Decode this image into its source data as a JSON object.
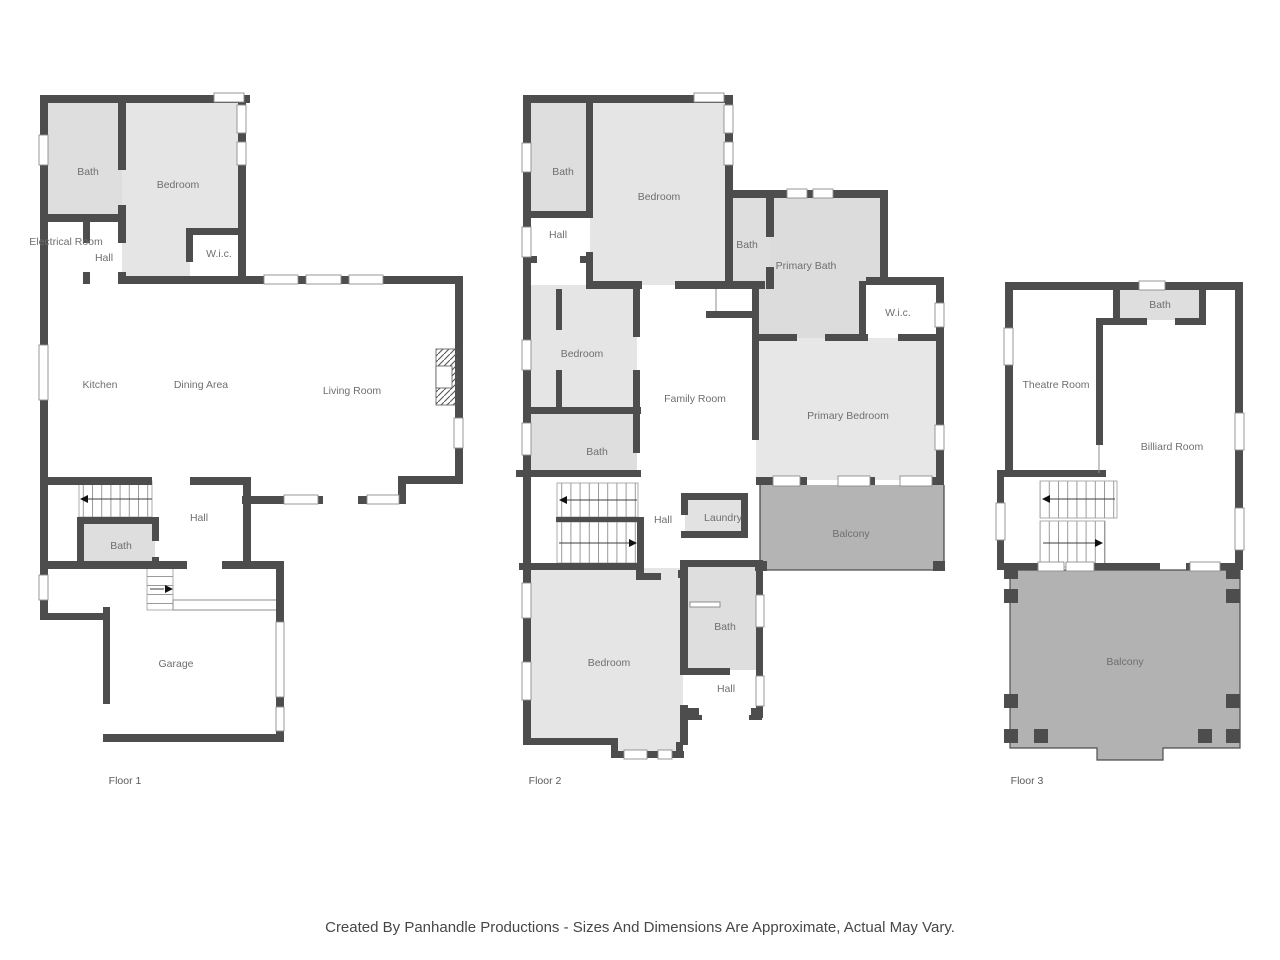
{
  "footer": {
    "text": "Created By Panhandle Productions - Sizes And Dimensions Are Approximate, Actual May Vary."
  },
  "colors": {
    "wall": "#4d4d4d",
    "room_light": "#e5e5e5",
    "room_bath": "#dedede",
    "balcony": "#b4b4b4",
    "label_text": "#6f6f6f",
    "background": "#ffffff"
  },
  "floors": [
    {
      "label": "Floor 1",
      "rooms": [
        {
          "name": "Bath"
        },
        {
          "name": "Bedroom"
        },
        {
          "name": "Electrical Room"
        },
        {
          "name": "Hall"
        },
        {
          "name": "W.i.c."
        },
        {
          "name": "Kitchen"
        },
        {
          "name": "Dining Area"
        },
        {
          "name": "Living Room"
        },
        {
          "name": "Hall"
        },
        {
          "name": "Bath"
        },
        {
          "name": "Garage"
        }
      ]
    },
    {
      "label": "Floor 2",
      "rooms": [
        {
          "name": "Bath"
        },
        {
          "name": "Bedroom"
        },
        {
          "name": "Hall"
        },
        {
          "name": "Bath"
        },
        {
          "name": "Primary Bath"
        },
        {
          "name": "W.i.c."
        },
        {
          "name": "Bedroom"
        },
        {
          "name": "Family Room"
        },
        {
          "name": "Primary Bedroom"
        },
        {
          "name": "Bath"
        },
        {
          "name": "Hall"
        },
        {
          "name": "Laundry"
        },
        {
          "name": "Balcony"
        },
        {
          "name": "Bedroom"
        },
        {
          "name": "Bath"
        },
        {
          "name": "Hall"
        }
      ]
    },
    {
      "label": "Floor 3",
      "rooms": [
        {
          "name": "Bath"
        },
        {
          "name": "Theatre Room"
        },
        {
          "name": "Billiard Room"
        },
        {
          "name": "Balcony"
        }
      ]
    }
  ]
}
